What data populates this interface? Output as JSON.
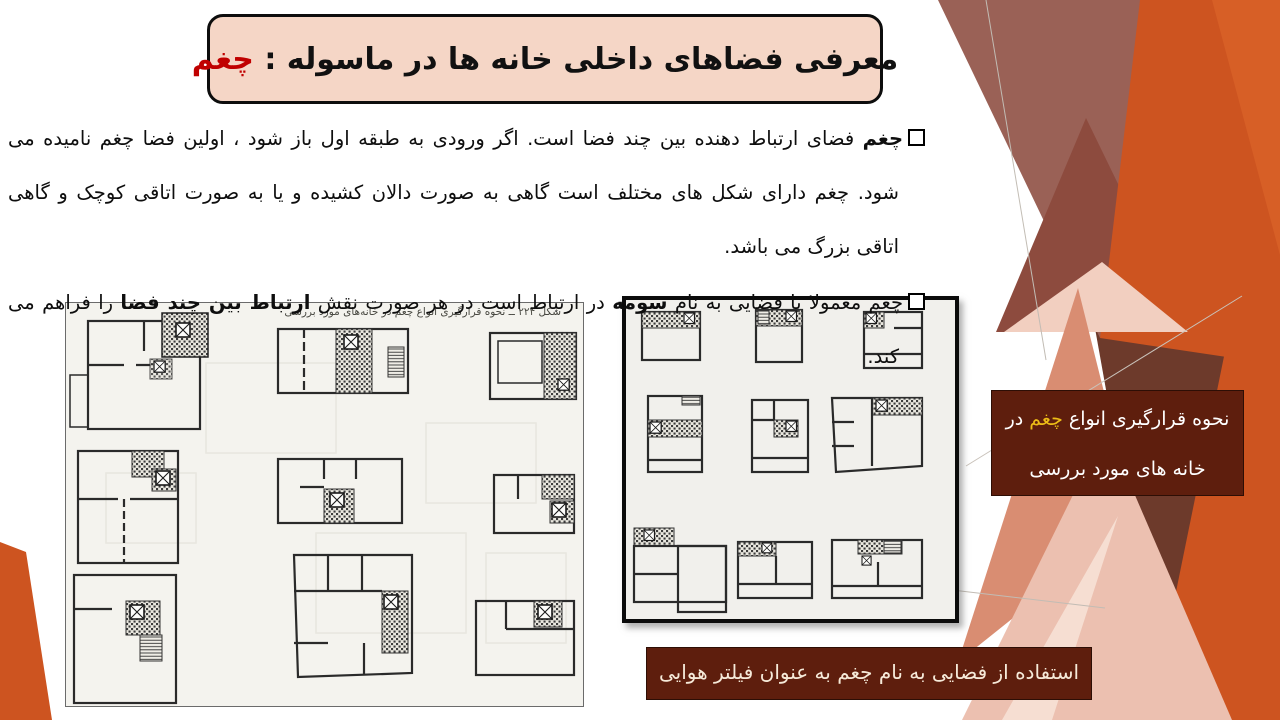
{
  "slide": {
    "title": {
      "main": "معرفی فضاهای داخلی خانه ها در ماسوله : ",
      "accent": "چغم"
    },
    "bullets": {
      "p1": {
        "lead_bold": "چغم",
        "rest": " فضای ارتباط دهنده بین چند فضا است. اگر ورودی به طبقه اول باز شود ، اولین فضا چغم نامیده می شود. چغم دارای شکل های مختلف است گاهی به صورت دالان کشیده و یا به صورت اتاقی کوچک و گاهی اتاقی بزرگ می باشد."
      },
      "p2": {
        "a": "چغم معمولا با فضایی به نام ",
        "b_bold": "سومه",
        "c": " در ارتباط است در هر صورت نقش ",
        "d_bold": "ارتباط بین چند فضا",
        "e": " را فراهم می کند."
      }
    },
    "left_figure": {
      "caption": "شکل ۲۲۴ ــ نحوه قرارگیری انواع چغم در خانه‌های مورد بررسی"
    },
    "right_caption": {
      "line1_a": "نحوه قرارگیری انواع ",
      "line1_accent": "چغم",
      "line1_b": " در",
      "line2": "خانه های مورد بررسی"
    },
    "bottom_caption": "استفاده از فضایی به نام چغم به عنوان فیلتر هوایی",
    "colors": {
      "accent_red": "#c00000",
      "caption_bg": "#5e1e0d",
      "caption_yellow": "#edbd17",
      "orange": "#cd5420",
      "mauve": "#9a6156",
      "title_bg": "#f5d6c6"
    }
  }
}
